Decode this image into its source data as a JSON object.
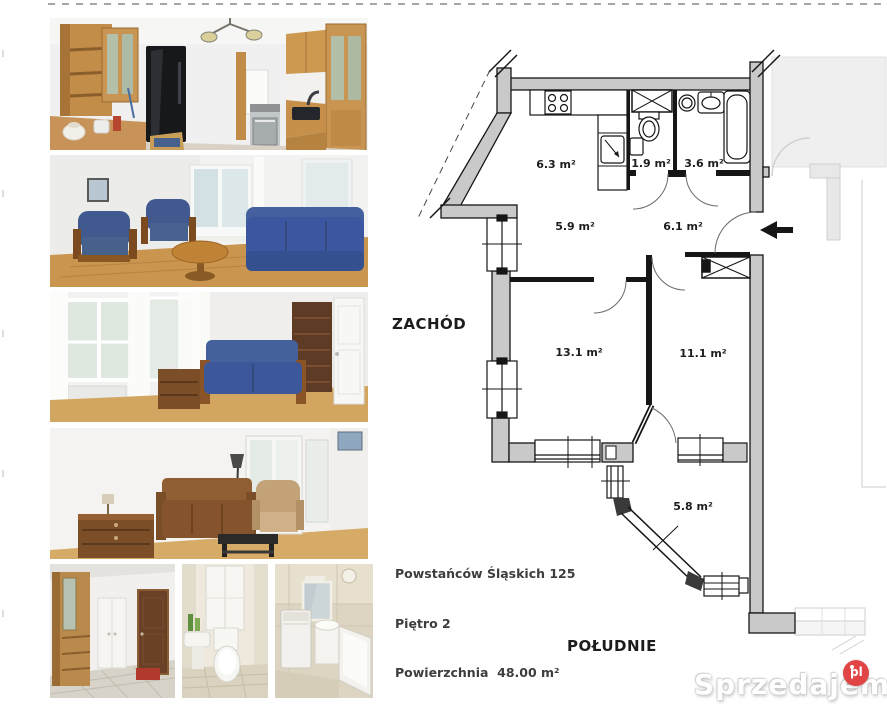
{
  "colors": {
    "wall_fill": "#c9c9c9",
    "wall_line": "#161616",
    "neighbor_line": "#cfcfcf",
    "badge": "#e04444",
    "text": "#1c1c1c"
  },
  "photos": {
    "items": [
      {
        "id": "kitchen"
      },
      {
        "id": "living-room"
      },
      {
        "id": "bedroom"
      },
      {
        "id": "sitting-room"
      },
      {
        "id": "hallway"
      },
      {
        "id": "toilet"
      },
      {
        "id": "bathroom"
      }
    ]
  },
  "floor_plan": {
    "rooms": [
      {
        "id": "kitchen",
        "area": "6.3 m²"
      },
      {
        "id": "wc",
        "area": "1.9 m²"
      },
      {
        "id": "bathroom",
        "area": "3.6 m²"
      },
      {
        "id": "hall-west",
        "area": "5.9 m²"
      },
      {
        "id": "hall-east",
        "area": "6.1 m²"
      },
      {
        "id": "room-large",
        "area": "13.1 m²"
      },
      {
        "id": "room-medium",
        "area": "11.1 m²"
      },
      {
        "id": "balcony",
        "area": "5.8 m²"
      }
    ],
    "directions": {
      "west": "ZACHÓD",
      "south": "POŁUDNIE"
    },
    "info": {
      "address": "Powstańców Śląskich 125",
      "floor": "Piętro 2",
      "area": "Powierzchnia  48.00 m²"
    }
  },
  "watermark": {
    "text": "Sprzedajemy",
    "suffix": "pl"
  }
}
